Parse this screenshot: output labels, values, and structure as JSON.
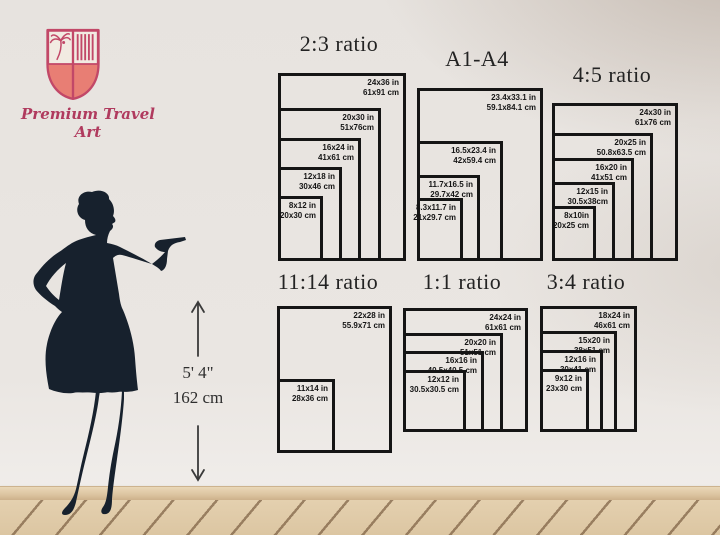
{
  "brand": {
    "name": "Premium Travel Art"
  },
  "height_reference": {
    "imperial": "5' 4\"",
    "metric": "162 cm"
  },
  "charts": [
    {
      "title": "2:3 ratio",
      "sizes": [
        {
          "in": "24x36 in",
          "cm": "61x91 cm"
        },
        {
          "in": "20x30 in",
          "cm": "51x76cm"
        },
        {
          "in": "16x24 in",
          "cm": "41x61 cm"
        },
        {
          "in": "12x18 in",
          "cm": "30x46 cm"
        },
        {
          "in": "8x12 in",
          "cm": "20x30 cm"
        }
      ]
    },
    {
      "title": "A1-A4",
      "sizes": [
        {
          "in": "23.4x33.1 in",
          "cm": "59.1x84.1 cm"
        },
        {
          "in": "16.5x23.4 in",
          "cm": "42x59.4 cm"
        },
        {
          "in": "11.7x16.5 in",
          "cm": "29.7x42 cm"
        },
        {
          "in": "8.3x11.7 in",
          "cm": "21x29.7 cm"
        }
      ]
    },
    {
      "title": "4:5 ratio",
      "sizes": [
        {
          "in": "24x30 in",
          "cm": "61x76 cm"
        },
        {
          "in": "20x25 in",
          "cm": "50.8x63.5 cm"
        },
        {
          "in": "16x20 in",
          "cm": "41x51 cm"
        },
        {
          "in": "12x15 in",
          "cm": "30.5x38cm"
        },
        {
          "in": "8x10in",
          "cm": "20x25 cm"
        }
      ]
    },
    {
      "title": "11:14 ratio",
      "sizes": [
        {
          "in": "22x28 in",
          "cm": "55.9x71 cm"
        },
        {
          "in": "11x14 in",
          "cm": "28x36 cm"
        }
      ]
    },
    {
      "title": "1:1 ratio",
      "sizes": [
        {
          "in": "24x24 in",
          "cm": "61x61 cm"
        },
        {
          "in": "20x20 in",
          "cm": "51x51 cm"
        },
        {
          "in": "16x16 in",
          "cm": "40.5x40.5 cm"
        },
        {
          "in": "12x12 in",
          "cm": "30.5x30.5 cm"
        }
      ]
    },
    {
      "title": "3:4 ratio",
      "sizes": [
        {
          "in": "18x24 in",
          "cm": "46x61 cm"
        },
        {
          "in": "15x20 in",
          "cm": "38x51 cm"
        },
        {
          "in": "12x16 in",
          "cm": "30x41 cm"
        },
        {
          "in": "9x12 in",
          "cm": "23x30 cm"
        }
      ]
    }
  ],
  "colors": {
    "accent": "#c24868",
    "crest_fill": "#e87e74",
    "ink": "#151515",
    "silhouette": "#17212d",
    "wall": "#e9e5e2"
  }
}
